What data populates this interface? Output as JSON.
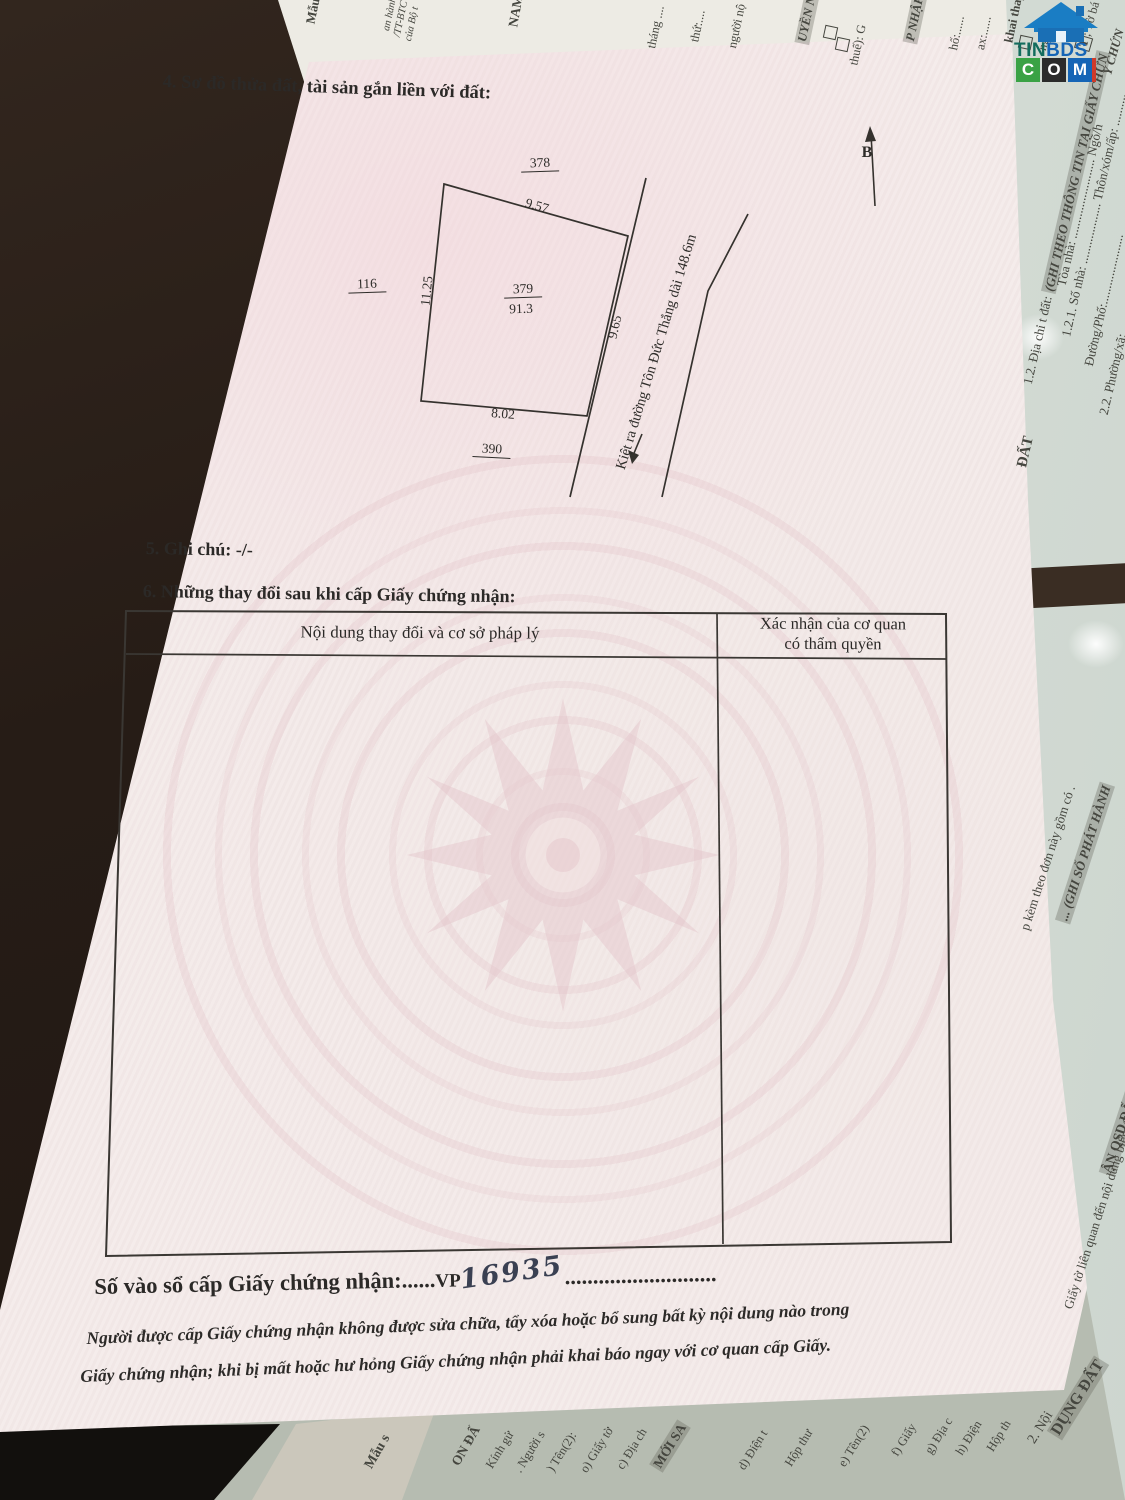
{
  "page_title": "Giấy chứng nhận quyền sử dụng đất - trang sơ đồ thửa đất",
  "colors": {
    "paper": "#f4ebea",
    "paper_pink_tint": "#f2d4db",
    "table_surface": "#2a1f18",
    "second_document": "#dde3dc",
    "ink": "#2b2927",
    "handwriting_ink": "#3a4052",
    "watermark_pink": "#e2c0c6",
    "logo_blue": "#1565b6",
    "logo_green": "#3aa245",
    "logo_teal": "#136c5e",
    "logo_dark": "#2b2b2b",
    "logo_red": "#d03a2a"
  },
  "sections": {
    "s4_title": "4. Sơ đồ thửa đất, tài sản gắn liền với đất:",
    "s5_title": "5. Ghi chú: -/-",
    "s6_title": "6. Những thay đổi sau khi cấp Giấy chứng nhận:"
  },
  "diagram": {
    "north_label": "B",
    "parcel_top": "378",
    "parcel_left": "116",
    "parcel_center": "379",
    "parcel_center_area": "91.3",
    "parcel_bottom": "390",
    "edge_top": "9.57",
    "edge_left": "11.25",
    "edge_right": "9.65",
    "edge_bottom": "8.02",
    "road_label": "Kiệt ra đường Tôn Đức Thắng dài 148.6m"
  },
  "table": {
    "col1_header": "Nội dung thay đổi và cơ sở pháp lý",
    "col2_header_line1": "Xác nhận của cơ quan",
    "col2_header_line2": "có thẩm quyền"
  },
  "serial": {
    "label": "Số vào sổ cấp Giấy chứng nhận:",
    "dots1": "......",
    "prefix": "VP",
    "number": "16935",
    "dots2": "..........................."
  },
  "footer": {
    "line1": "Người được cấp Giấy chứng nhận không được sửa chữa, tẩy xóa hoặc bổ sung bất kỳ nội dung nào trong",
    "line2": "Giấy chứng nhận; khi bị mất hoặc hư hỏng Giấy chứng nhận phải khai báo ngay với cơ quan cấp Giấy."
  },
  "logo": {
    "tin": "TIN",
    "bds": "BDS",
    "c": "C",
    "o": "O",
    "m": "M"
  },
  "fragments": {
    "top": {
      "f1": "Mẫu",
      "f2": "an hành",
      "f3": "/TT-BTC",
      "f4": "của Bộ t",
      "f5": "NAM",
      "f6": "tháng ....",
      "f7": "thứ:....",
      "f8": "người nộ",
      "f9": "UYỀN N",
      "f10": "thuế): G",
      "f11": "P NHẬP",
      "f12": "hố:......",
      "f13": "ax:......",
      "f14": "khai thay",
      "f15": "ngày......",
      "f16": "T",
      "f17": "; Tờ bá",
      "f18": "Y CHỨN"
    },
    "right": {
      "dat": "ĐẤT",
      "l1a": "1.2. Địa chỉ t     đất: ",
      "l1b": "(GHI THEO THÔNG TIN TẠI GIẤY CHỨN",
      "l2": "Tòa nhà: ......................... Ngõ/h",
      "l3": "1.2.1. Số nhà: ................... Thôn/xóm/ấp: ..........",
      "l4": "Đường/Phố:......................",
      "l5": "2.2. Phường/xã: .............",
      "l6": "p kèm theo đơn này gồm có .",
      "l7": "... (GHI SỐ PHÁT HÀNH",
      "l8": "Giấy tờ liên quan đến nội dung biến động nộp",
      "l9": "ẬN QSD ĐẤT SỐ..",
      "l10": "DỤNG ĐẤT",
      "l11": "2. Nội"
    },
    "bottom": {
      "b1": "Mẫu s",
      "b2": "ON ĐẤ",
      "b3": "Kính gử",
      "b4": ". Người s",
      "b5": ") Tên(2):",
      "b6": "o) Giấy tờ",
      "b7": "c) Địa ch",
      "b8": "MỚI SA",
      "b9": "d) Điện t",
      "b10": "Hộp thư",
      "b11": "e) Tên(2)",
      "b12": "f) Giấy",
      "b13": "g) Địa c",
      "b14": "h) Điện",
      "b15": "Hộp th"
    }
  }
}
